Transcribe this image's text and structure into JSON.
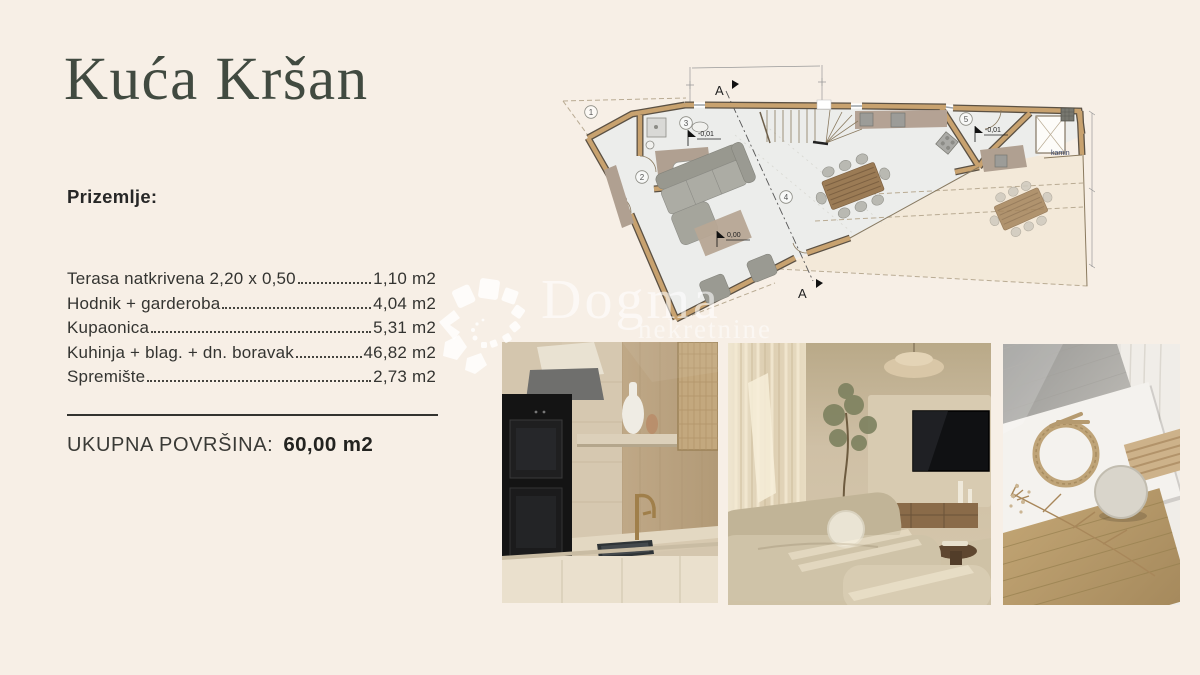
{
  "page": {
    "title": "Kuća Kršan",
    "section_label": "Prizemlje:"
  },
  "areas": {
    "rooms": [
      {
        "label": "Terasa natkrivena 2,20 x 0,50",
        "value": "1,10 m2"
      },
      {
        "label": "Hodnik + garderoba",
        "value": "4,04 m2"
      },
      {
        "label": "Kupaonica",
        "value": "5,31 m2"
      },
      {
        "label": "Kuhinja + blag. + dn. boravak",
        "value": "46,82 m2"
      },
      {
        "label": "Spremište",
        "value": "2,73 m2"
      }
    ],
    "total_label": "UKUPNA POVRŠINA:",
    "total_value": "60,00 m2"
  },
  "floorplan": {
    "section_marker": "A",
    "room_numbers": [
      "1",
      "2",
      "3",
      "4",
      "5"
    ],
    "level_markers": {
      "bath": "-0,01",
      "main": "0,00",
      "storage": "-0,01"
    },
    "kamin_label": "kamin"
  },
  "watermark": {
    "brand": "Dogma",
    "tagline": "nekretnine"
  },
  "photos": [
    {
      "icon": "kitchen-photo"
    },
    {
      "icon": "living-room-photo"
    },
    {
      "icon": "material-flatlay-photo"
    }
  ],
  "colors": {
    "background": "#f7efe6",
    "title": "#414a40",
    "text": "#343431",
    "wall_tan": "#c8a26f",
    "floor_gray": "#ecedeb",
    "taupe": "#b0a091",
    "watermark": "rgba(255,255,255,0.58)"
  }
}
